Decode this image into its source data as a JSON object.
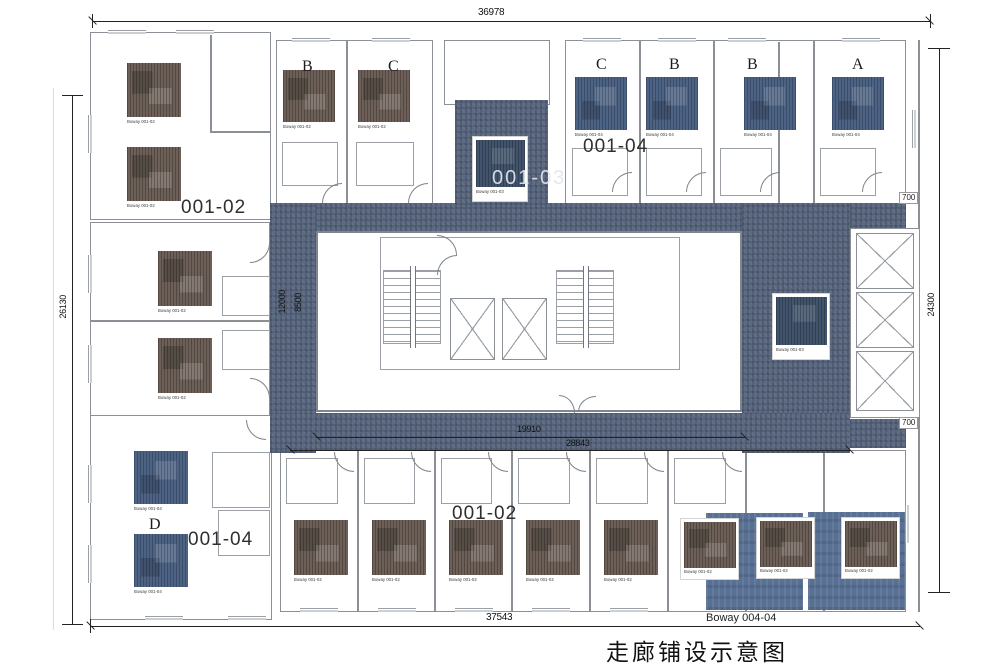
{
  "title": "走廊铺设示意图",
  "dimensions": {
    "top": "36978",
    "left": "26130",
    "right": "24300",
    "bottom": "37543",
    "corridor_inner": "19910",
    "corridor_outer": "28843",
    "core_outer": "12000",
    "core_inner": "8500",
    "corridor_width_top": "700",
    "corridor_width_bottom": "700"
  },
  "areas": {
    "top_left": "001-02",
    "top_right": "001-04",
    "center": "001-03",
    "bottom_left": "001-04",
    "bottom": "001-02"
  },
  "room_letters": {
    "top_b": "B",
    "top_c": "C",
    "right_c": "C",
    "right_b1": "B",
    "right_b2": "B",
    "right_a": "A",
    "bottom_d": "D"
  },
  "swatches": {
    "brown": "Boway 001-02",
    "blue": "Boway 001-04",
    "dark": "Boway 001-03",
    "panel": "Boway 004-04"
  },
  "colors": {
    "corridor": "#5c6a83",
    "carpet_brown": "#6c6058",
    "carpet_blue": "#4d6384",
    "carpet_dark": "#42546c",
    "panel_blue": "#587093",
    "wall": "#8a9096"
  }
}
